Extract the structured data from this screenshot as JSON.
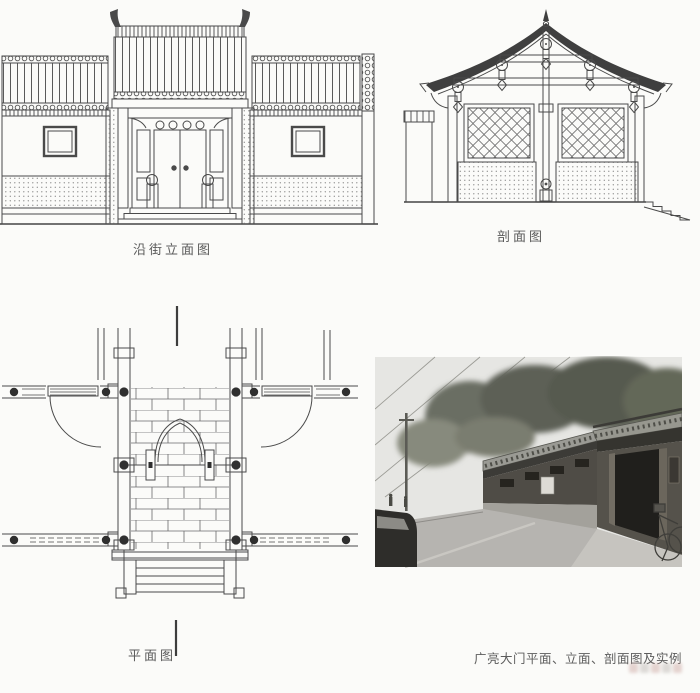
{
  "page": {
    "background": "#fbfbf9",
    "ink": "#4a4a4a",
    "label_color": "#5a5a5a",
    "caption_color": "#5c5c5c"
  },
  "figures": {
    "elevation": {
      "label": "沿街立面图"
    },
    "section": {
      "label": "剖面图"
    },
    "plan": {
      "label": "平面图"
    }
  },
  "caption": "广亮大门平面、立面、剖面图及实例"
}
